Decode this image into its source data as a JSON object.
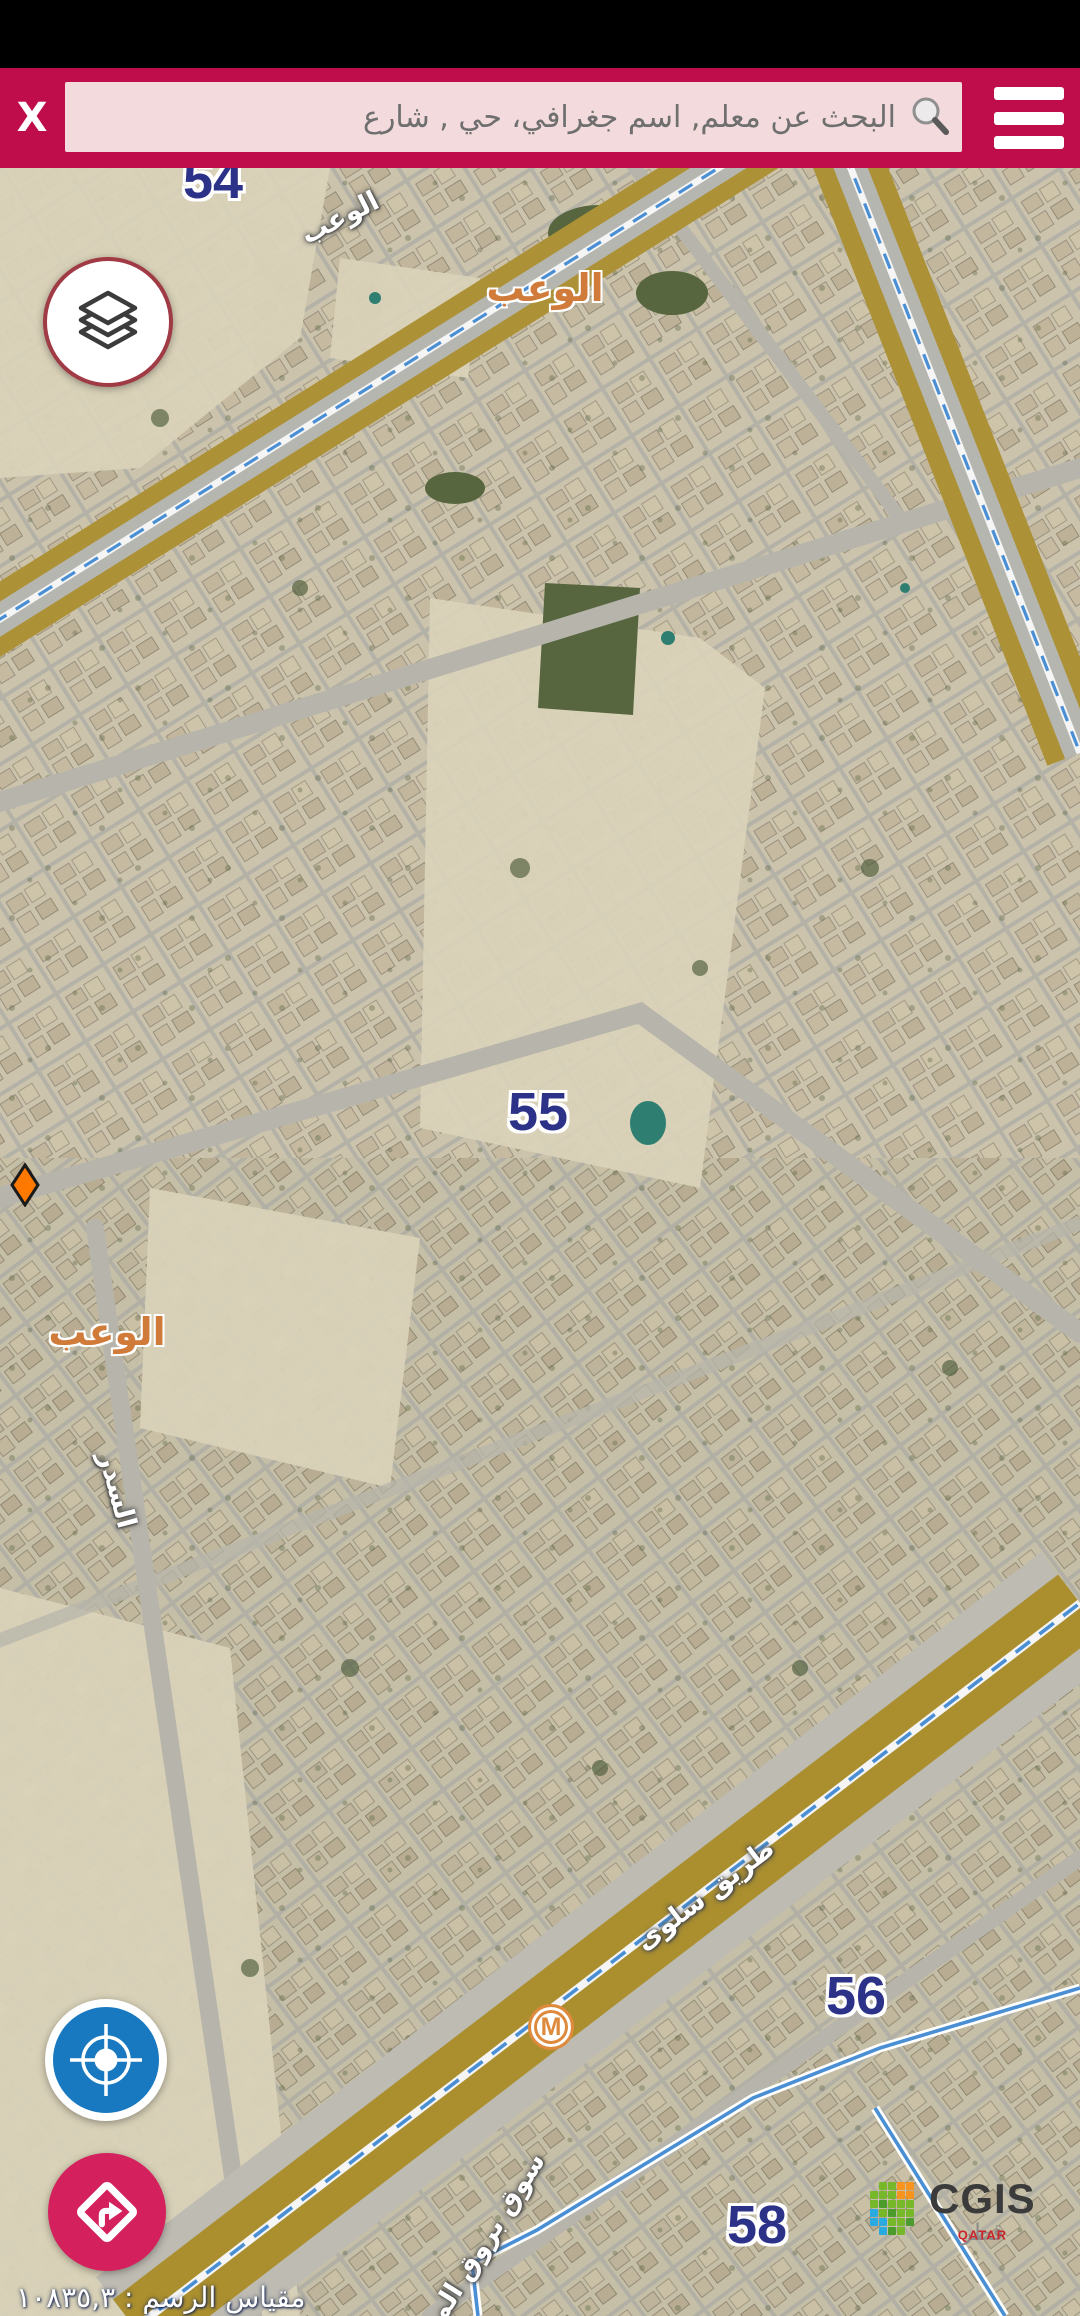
{
  "header": {
    "close_label": "X",
    "search_placeholder": "البحث عن معلم, اسم جغرافي، حي , شارع",
    "colors": {
      "bar": "#BF0D4B",
      "search_bg": "#F3DBDD"
    }
  },
  "map": {
    "zone_labels": [
      {
        "text": "54",
        "x": 213,
        "y": 12
      },
      {
        "text": "55",
        "x": 538,
        "y": 944
      },
      {
        "text": "56",
        "x": 856,
        "y": 1828
      },
      {
        "text": "58",
        "x": 757,
        "y": 2057
      }
    ],
    "district_labels": [
      {
        "text": "الوعب",
        "x": 545,
        "y": 120
      },
      {
        "text": "الوعب",
        "x": 107,
        "y": 1164
      }
    ],
    "street_labels": [
      {
        "text": "الوعب",
        "x": 340,
        "y": 50,
        "rot": -27
      },
      {
        "text": "السدر",
        "x": 117,
        "y": 1322,
        "rot": 75
      },
      {
        "text": "طريق سلوى",
        "x": 705,
        "y": 1727,
        "rot": -37
      },
      {
        "text": "سوق بروق المركزي",
        "x": 468,
        "y": 2100,
        "rot": -58
      }
    ],
    "scale_label": "مقياس الرسم : ١٠٨٣٥,٣",
    "colors": {
      "zone_text": "#2B3288",
      "district_text": "#D07B3A",
      "street_text": "#FFFFFF",
      "highway_median": "#AC9136",
      "boundary_blue": "#4A8FD4"
    }
  },
  "widgets": {
    "metro_label": "M",
    "marker_color": "#FF7800",
    "locate_bg": "#1878C0",
    "directions_bg": "#D4205C",
    "layers_border": "#A03A44",
    "metro_orange": "#DD8A3C"
  },
  "logo": {
    "title": "CGIS",
    "ar": "قطر",
    "en": "QATAR",
    "grid": [
      ".GGOO.",
      "GGGOO.",
      "GgGGG.",
      "BGgGG.",
      "BBGGg.",
      ".BgG.."
    ],
    "palette": {
      "G": "#76B82A",
      "g": "#4C9C2D",
      "O": "#F7941E",
      "B": "#29ABE1"
    }
  }
}
